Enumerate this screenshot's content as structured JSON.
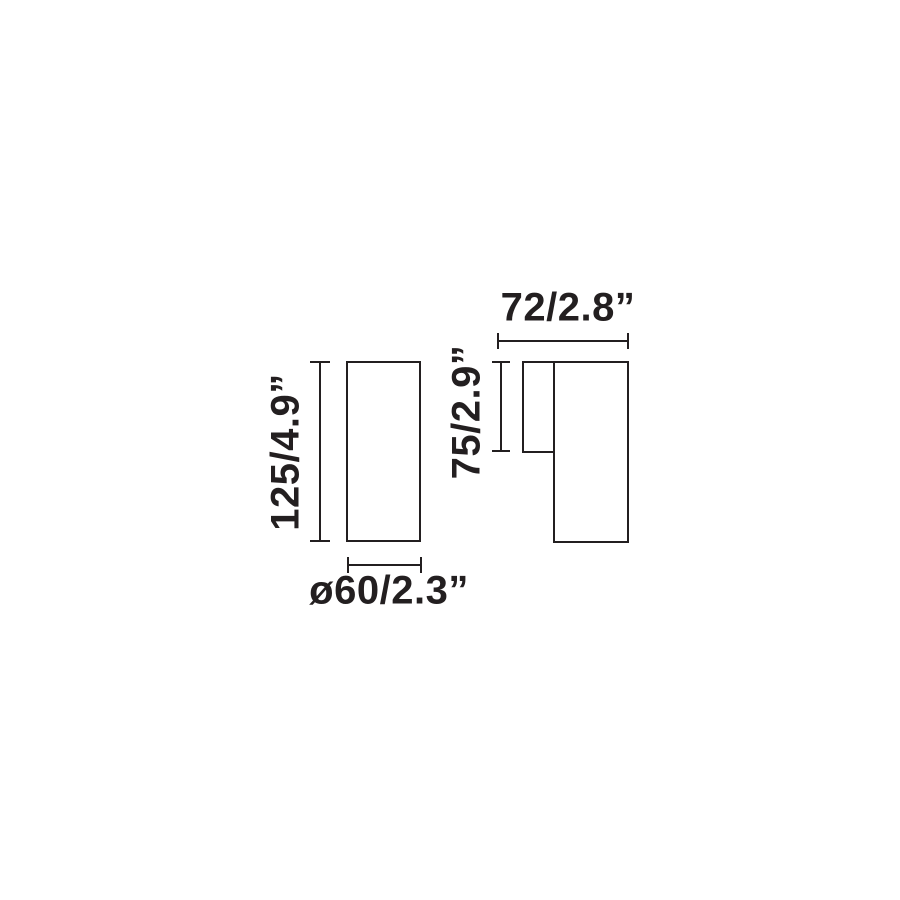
{
  "diagram": {
    "ink_color": "#231f20",
    "front_view": {
      "height_label": "125/4.9”",
      "diameter_label": "ø60/2.3”"
    },
    "side_view": {
      "depth_label": "72/2.8”",
      "body_height_label": "75/2.9”"
    }
  }
}
